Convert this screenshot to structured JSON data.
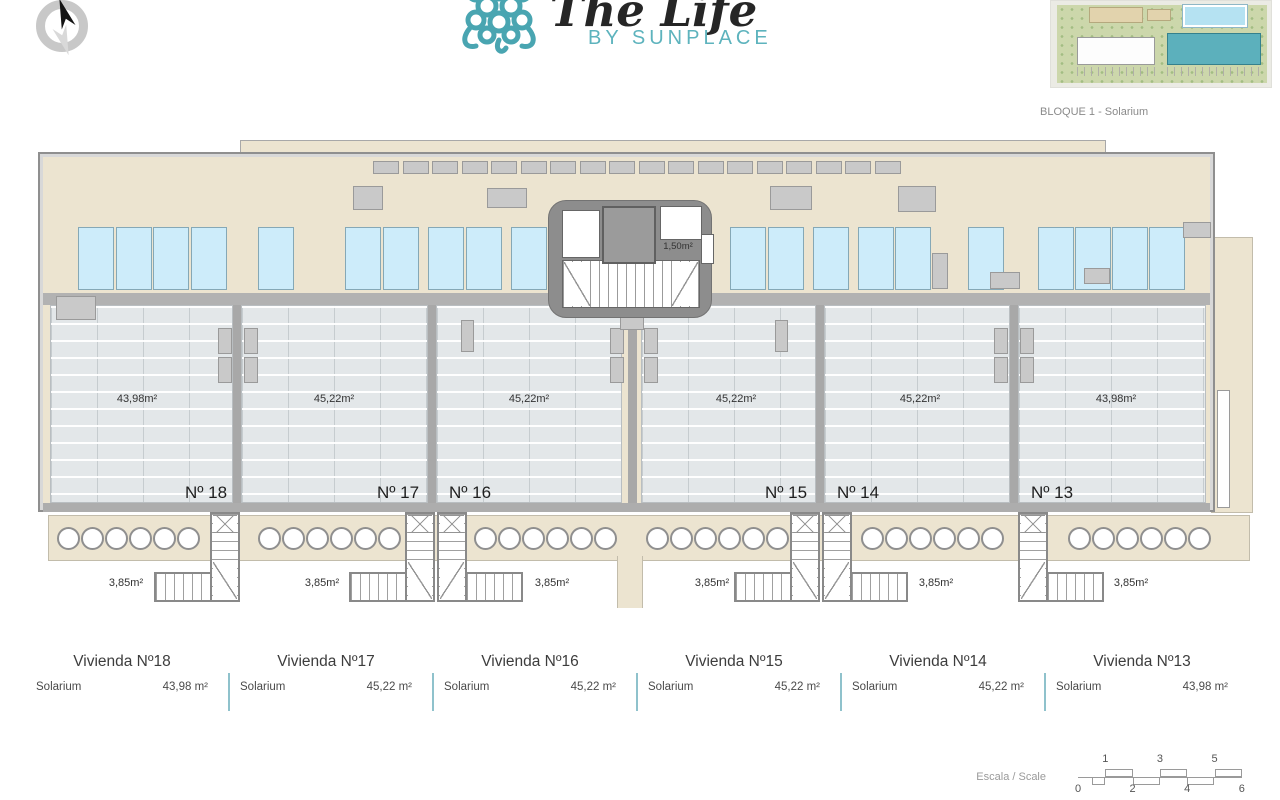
{
  "header": {
    "logo_title": "The Life",
    "logo_subtitle": "BY SUNPLACE",
    "brand_teal": "#4aa5b1"
  },
  "key_plan": {
    "caption": "BLOQUE 1 - Solarium"
  },
  "plan": {
    "room_label": "1,50m²",
    "stair_label": "3,85m²",
    "area_labels": [
      {
        "text": "43,98m²",
        "cx": 137
      },
      {
        "text": "45,22m²",
        "cx": 334
      },
      {
        "text": "45,22m²",
        "cx": 529
      },
      {
        "text": "45,22m²",
        "cx": 736
      },
      {
        "text": "45,22m²",
        "cx": 920
      },
      {
        "text": "43,98m²",
        "cx": 1116
      }
    ],
    "unit_labels": [
      {
        "text": "Nº 18",
        "cx": 206
      },
      {
        "text": "Nº 17",
        "cx": 398
      },
      {
        "text": "Nº 16",
        "cx": 470
      },
      {
        "text": "Nº 15",
        "cx": 786
      },
      {
        "text": "Nº 14",
        "cx": 858
      },
      {
        "text": "Nº 13",
        "cx": 1052
      }
    ],
    "geometry": {
      "terrace": {
        "y": 305,
        "h": 198
      },
      "terraces": [
        {
          "id": 18,
          "x": 50,
          "w": 183
        },
        {
          "id": 17,
          "x": 241,
          "w": 187
        },
        {
          "id": 16,
          "x": 436,
          "w": 186
        },
        {
          "id": 15,
          "x": 641,
          "w": 175
        },
        {
          "id": 14,
          "x": 824,
          "w": 186
        },
        {
          "id": 13,
          "x": 1018,
          "w": 188
        }
      ],
      "partitions": [
        {
          "x": 233,
          "w": 8
        },
        {
          "x": 428,
          "w": 8
        },
        {
          "x": 816,
          "w": 8
        },
        {
          "x": 1010,
          "w": 8
        },
        {
          "x": 628,
          "w": 9
        }
      ],
      "solar_panels": {
        "y": 227,
        "w": 36,
        "h": 63,
        "xs": [
          78,
          116,
          153,
          191,
          258,
          345,
          383,
          428,
          466,
          511,
          730,
          768,
          813,
          858,
          895,
          968,
          1038,
          1075,
          1112,
          1149
        ]
      },
      "top_vents": {
        "y": 161,
        "w": 26,
        "h": 13,
        "start": 373,
        "step": 29.5,
        "count": 18
      },
      "gray_blocks": [
        {
          "x": 353,
          "y": 186,
          "w": 30,
          "h": 24
        },
        {
          "x": 487,
          "y": 188,
          "w": 40,
          "h": 20
        },
        {
          "x": 770,
          "y": 186,
          "w": 42,
          "h": 24
        },
        {
          "x": 898,
          "y": 186,
          "w": 38,
          "h": 26
        },
        {
          "x": 932,
          "y": 253,
          "w": 16,
          "h": 36
        },
        {
          "x": 990,
          "y": 272,
          "w": 30,
          "h": 17
        },
        {
          "x": 1084,
          "y": 268,
          "w": 26,
          "h": 16
        },
        {
          "x": 56,
          "y": 296,
          "w": 40,
          "h": 24
        },
        {
          "x": 1183,
          "y": 222,
          "w": 28,
          "h": 16
        },
        {
          "x": 218,
          "y": 328,
          "w": 14,
          "h": 26
        },
        {
          "x": 218,
          "y": 357,
          "w": 14,
          "h": 26
        },
        {
          "x": 244,
          "y": 328,
          "w": 14,
          "h": 26
        },
        {
          "x": 244,
          "y": 357,
          "w": 14,
          "h": 26
        },
        {
          "x": 610,
          "y": 328,
          "w": 14,
          "h": 26
        },
        {
          "x": 610,
          "y": 357,
          "w": 14,
          "h": 26
        },
        {
          "x": 644,
          "y": 328,
          "w": 14,
          "h": 26
        },
        {
          "x": 644,
          "y": 357,
          "w": 14,
          "h": 26
        },
        {
          "x": 994,
          "y": 328,
          "w": 14,
          "h": 26
        },
        {
          "x": 994,
          "y": 357,
          "w": 14,
          "h": 26
        },
        {
          "x": 1020,
          "y": 328,
          "w": 14,
          "h": 26
        },
        {
          "x": 1020,
          "y": 357,
          "w": 14,
          "h": 26
        },
        {
          "x": 461,
          "y": 320,
          "w": 13,
          "h": 32
        },
        {
          "x": 775,
          "y": 320,
          "w": 13,
          "h": 32
        },
        {
          "x": 620,
          "y": 310,
          "w": 24,
          "h": 20
        }
      ],
      "circles": {
        "y": 527,
        "d": 23,
        "groups": [
          {
            "x0": 57,
            "n": 6,
            "dx": 24
          },
          {
            "x0": 258,
            "n": 6,
            "dx": 24
          },
          {
            "x0": 474,
            "n": 6,
            "dx": 24
          },
          {
            "x0": 646,
            "n": 6,
            "dx": 24
          },
          {
            "x0": 861,
            "n": 6,
            "dx": 24
          },
          {
            "x0": 1068,
            "n": 6,
            "dx": 24
          }
        ]
      },
      "stairs": [
        {
          "unit": 18,
          "shaft_x": 210,
          "dir": "left",
          "label_cx": 126
        },
        {
          "unit": 17,
          "shaft_x": 405,
          "dir": "left",
          "label_cx": 322
        },
        {
          "unit": 16,
          "shaft_x": 437,
          "dir": "right",
          "label_cx": 552
        },
        {
          "unit": 15,
          "shaft_x": 790,
          "dir": "left",
          "label_cx": 712
        },
        {
          "unit": 14,
          "shaft_x": 822,
          "dir": "right",
          "label_cx": 936
        },
        {
          "unit": 13,
          "shaft_x": 1018,
          "dir": "right",
          "label_cx": 1131
        }
      ]
    }
  },
  "legend_table": {
    "columns": [
      {
        "title": "Vivienda Nº18",
        "label": "Solarium",
        "value": "43,98 m²"
      },
      {
        "title": "Vivienda Nº17",
        "label": "Solarium",
        "value": "45,22 m²"
      },
      {
        "title": "Vivienda Nº16",
        "label": "Solarium",
        "value": "45,22 m²"
      },
      {
        "title": "Vivienda Nº15",
        "label": "Solarium",
        "value": "45,22 m²"
      },
      {
        "title": "Vivienda Nº14",
        "label": "Solarium",
        "value": "45,22 m²"
      },
      {
        "title": "Vivienda Nº13",
        "label": "Solarium",
        "value": "43,98 m²"
      }
    ]
  },
  "scale_bar": {
    "label": "Escala / Scale",
    "top": [
      {
        "t": "1",
        "v": 1
      },
      {
        "t": "3",
        "v": 3
      },
      {
        "t": "5",
        "v": 5
      }
    ],
    "bottom": [
      {
        "t": "0",
        "v": 0
      },
      {
        "t": "2",
        "v": 2
      },
      {
        "t": "4",
        "v": 4
      },
      {
        "t": "6",
        "v": 6
      }
    ]
  }
}
